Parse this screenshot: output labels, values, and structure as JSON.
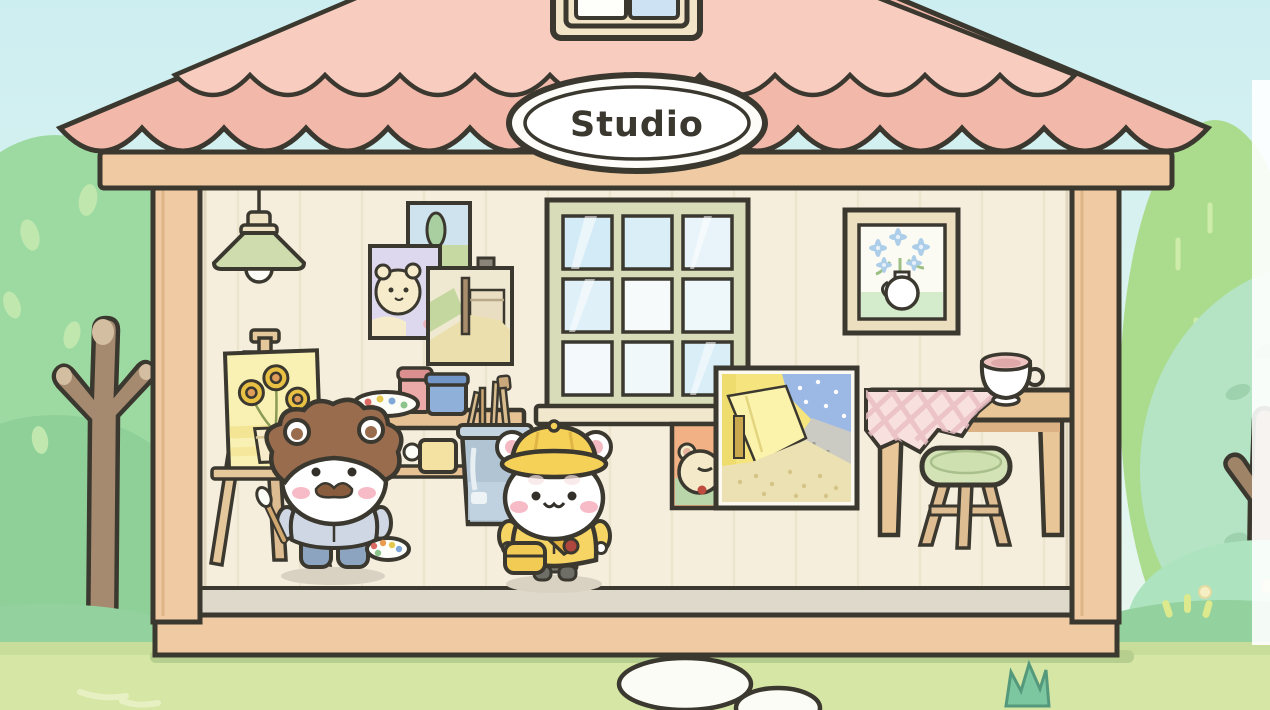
{
  "scene": {
    "sign_label": "Studio",
    "characters": [
      {
        "name": "painter-hamster",
        "look": "white hamster, brown curly hair and mustache, pale blue shirt, jeans, holds paint palette and brush"
      },
      {
        "name": "student-hamster",
        "look": "white hamster, yellow hat and smock, shoulder strap satchel with red apple charm"
      }
    ],
    "room_items": [
      "hanging-lamp",
      "easel-sunflower-canvas",
      "wall-picture-tree",
      "wall-picture-hamster-portrait",
      "wall-picture-house-landscape",
      "nine-pane-window",
      "framed-flower-still-life",
      "paint-supply-bench",
      "paint-palette",
      "pink-paint-pot",
      "blue-paint-pot",
      "yellow-paint-pot",
      "brush-bucket",
      "leaning-painting-hamster-portrait",
      "leaning-painting-cafe-terrace",
      "wooden-table",
      "gingham-tablecloth",
      "teacup",
      "green-stool"
    ],
    "outdoor_items": [
      "round-leafy-tree",
      "bare-branch-tree",
      "cypress-bush",
      "flowering-bush",
      "stepping-stones",
      "grass-tuft",
      "grass-sparkles"
    ],
    "colors": {
      "ink_outline": "#3b382f",
      "roof_pink": "#f2b9ab",
      "roof_pink_light": "#f8cdc0",
      "wood_tan": "#eecaa4",
      "wall_cream": "#f5eedd",
      "window_sage": "#d9dcb8",
      "grass_green": "#d6e6a5",
      "tree_green": "#9ddaa2",
      "hamster_yellow": "#f5d158",
      "shirt_blue": "#ced7e3",
      "sky_blue": "#d8f1ef",
      "sign_white": "#ffffff"
    }
  }
}
